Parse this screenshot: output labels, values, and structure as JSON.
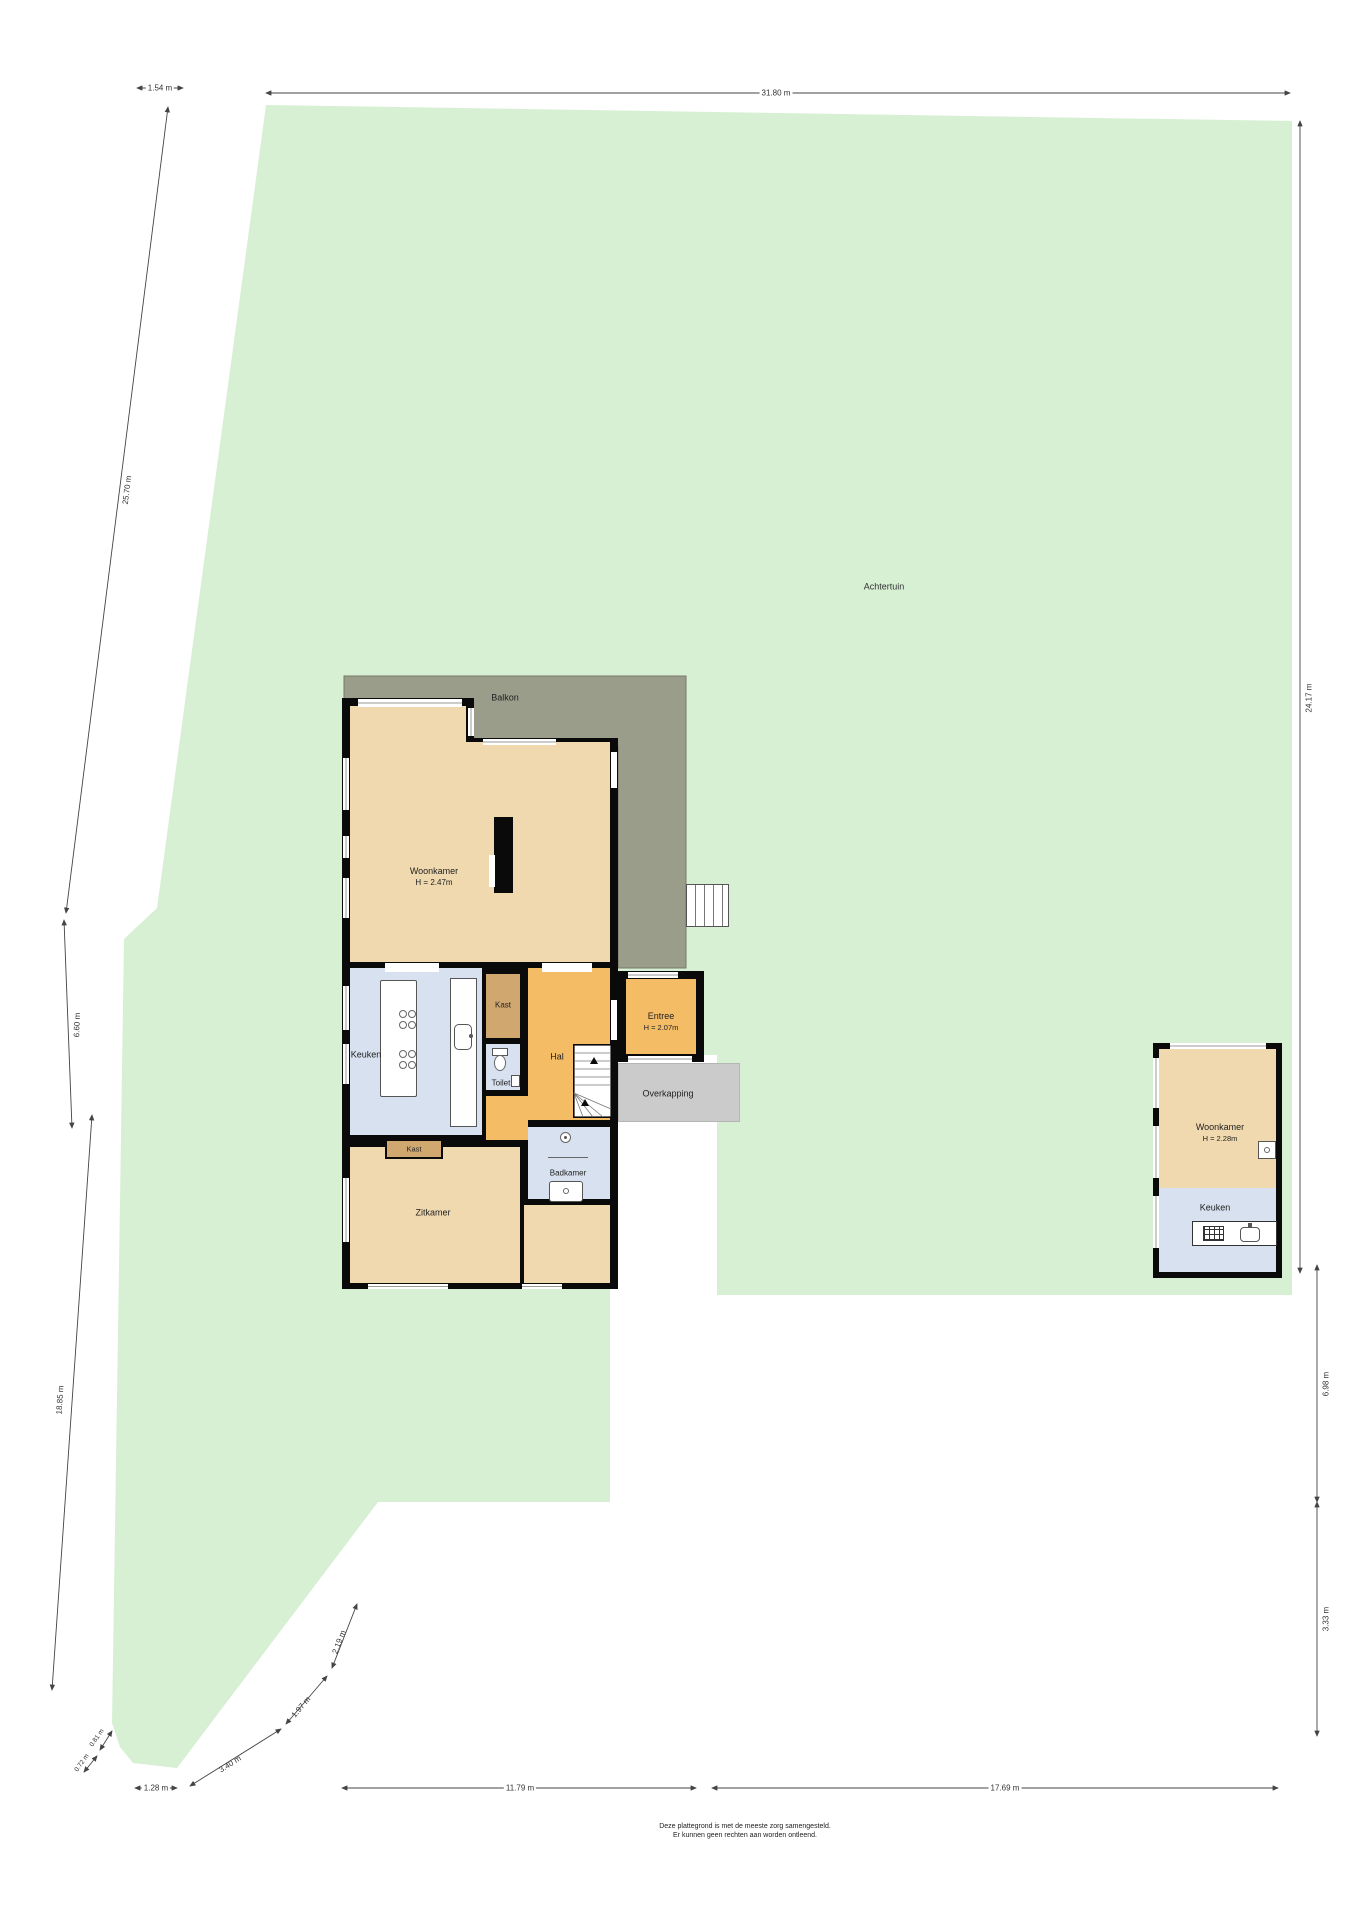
{
  "plan": {
    "site_label": "Achtertuin",
    "rooms": {
      "balkon": {
        "label": "Balkon"
      },
      "woonkamer": {
        "label": "Woonkamer",
        "height": "H = 2.47m"
      },
      "keuken": {
        "label": "Keuken"
      },
      "kast1": {
        "label": "Kast"
      },
      "toilet": {
        "label": "Toilet"
      },
      "hal": {
        "label": "Hal"
      },
      "entree": {
        "label": "Entree",
        "height": "H = 2.07m"
      },
      "overkapping": {
        "label": "Overkapping"
      },
      "kast2": {
        "label": "Kast"
      },
      "badkamer": {
        "label": "Badkamer"
      },
      "zitkamer": {
        "label": "Zitkamer"
      },
      "guest_woonkamer": {
        "label": "Woonkamer",
        "height": "H = 2.28m"
      },
      "guest_keuken": {
        "label": "Keuken"
      }
    },
    "dimensions": {
      "top_offset": "1.54 m",
      "top_width": "31.80 m",
      "left_upper": "25.70 m",
      "left_mid": "6.60 m",
      "left_lower": "18.85 m",
      "right_upper": "24.17 m",
      "right_mid": "6.98 m",
      "right_lower": "3.33 m",
      "bottom_left": "11.79 m",
      "bottom_right": "17.69 m",
      "corner_a": "0.81 m",
      "corner_b": "0.72 m",
      "corner_c": "1.28 m",
      "corner_d": "3.40 m",
      "corner_e": "1.97 m",
      "corner_f": "2.19 m"
    },
    "disclaimer": {
      "line1": "Deze plattegrond is met de meeste zorg samengesteld.",
      "line2": "Er kunnen geen rechten aan worden ontleend."
    },
    "colors": {
      "lot_green": "#d7f0d4",
      "balcony": "#9b9d8b",
      "living": "#f0d9ae",
      "hall": "#f5bc66",
      "closet": "#d0a76f",
      "wet_room": "#d7e1ef",
      "canopy": "#cbcbcb",
      "wall": "#0a0a0a"
    }
  }
}
